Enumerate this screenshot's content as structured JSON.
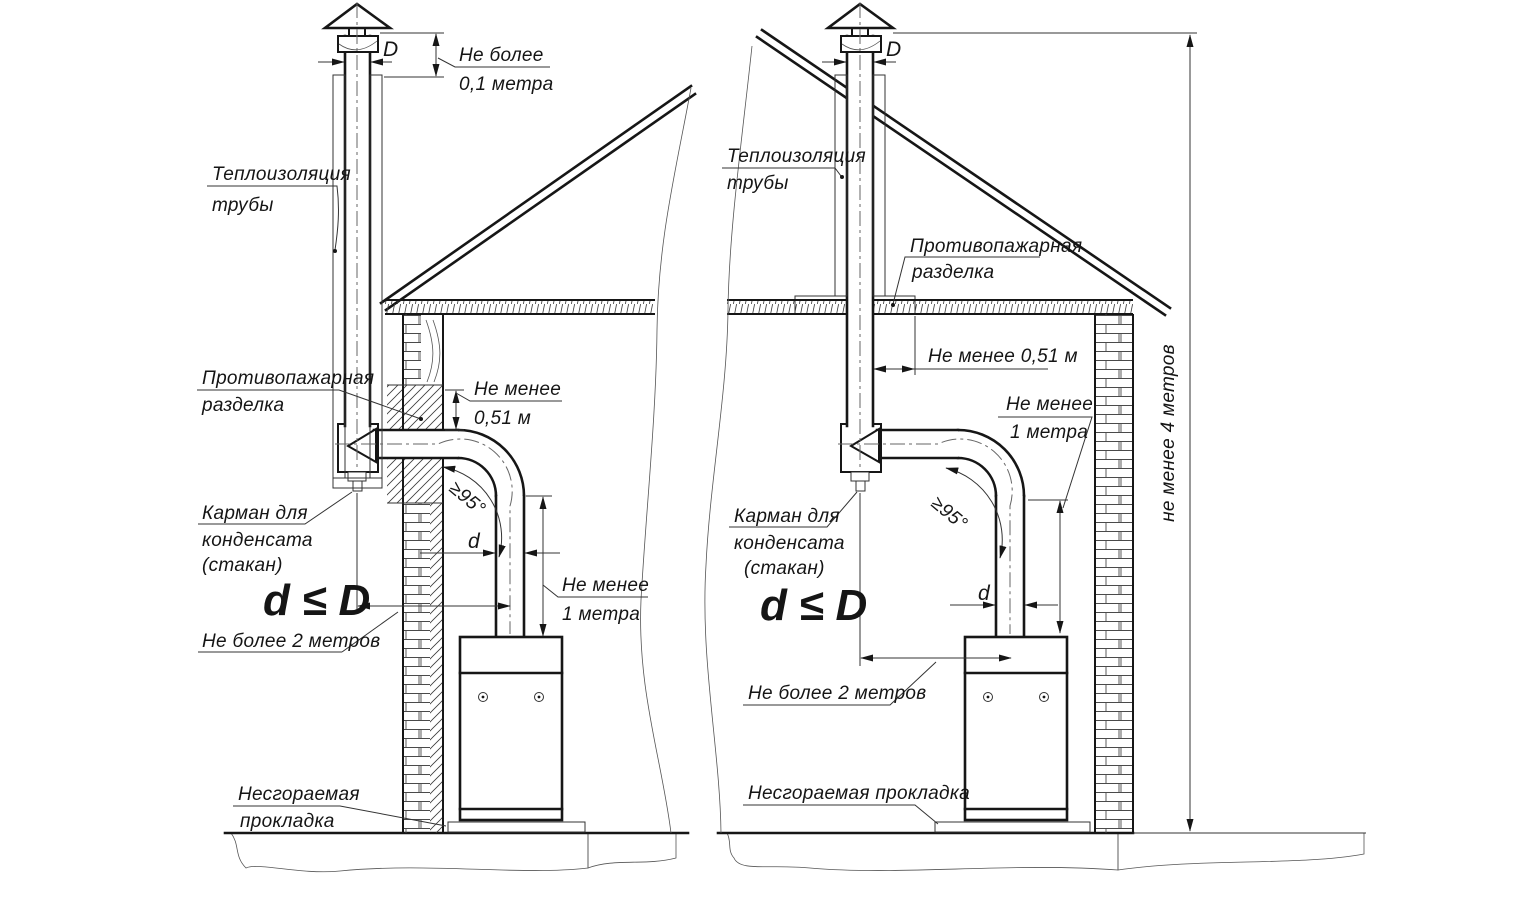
{
  "left": {
    "d_top": "D",
    "cap_limit": [
      "Не более",
      "0,1 метра"
    ],
    "insulation": [
      "Теплоизоляция",
      "трубы"
    ],
    "cutting": [
      "Противопажарная",
      "разделка"
    ],
    "min_051": [
      "Не менее",
      "0,51 м"
    ],
    "angle": "≥95°",
    "pocket": [
      "Карман для",
      "конденсата",
      "(стакан)"
    ],
    "d_small": "d",
    "d_le_D": "d ≤ D",
    "min_1m": [
      "Не менее",
      "1 метра"
    ],
    "max_2m": "Не более 2 метров",
    "gasket": [
      "Несгораемая",
      "прокладка"
    ]
  },
  "right": {
    "d_top": "D",
    "insulation": [
      "Теплоизоляция",
      "трубы"
    ],
    "cutting": [
      "Противопажарная",
      "разделка"
    ],
    "min_051": "Не менее 0,51 м",
    "min_1m": [
      "Не менее",
      "1 метра"
    ],
    "angle": "≥95°",
    "pocket": [
      "Карман для",
      "конденсата",
      "(стакан)"
    ],
    "d_le_D": "d ≤ D",
    "d_small": "d",
    "max_2m": "Не более 2 метров",
    "gasket": "Несгораемая прокладка",
    "min_4m": "не менее 4 метров"
  },
  "colors": {
    "line": "#161616",
    "thin_line": "#333333",
    "background": "#ffffff"
  }
}
